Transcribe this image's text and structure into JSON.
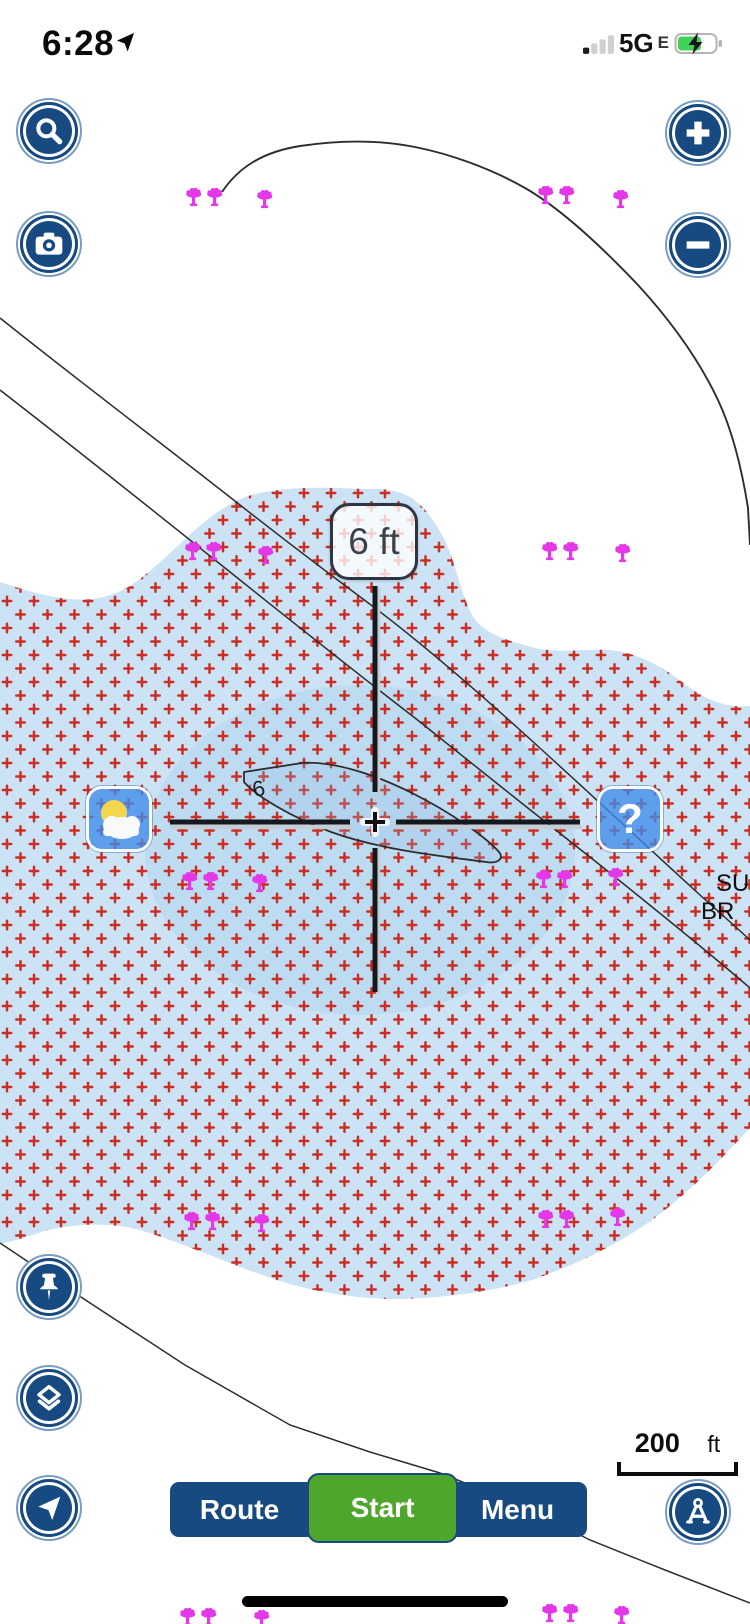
{
  "status_bar": {
    "time": "6:28",
    "network": "5G",
    "network_band": "E"
  },
  "map": {
    "depth_label": "6 ft",
    "contour_depth_label": "6",
    "place_name": {
      "line1": "SU",
      "line2": "BR"
    },
    "scale_bar": {
      "distance": "200",
      "unit": "ft"
    },
    "markers": [
      {
        "kind": "pair",
        "x": 184,
        "y": 186
      },
      {
        "kind": "single",
        "x": 255,
        "y": 188
      },
      {
        "kind": "pair",
        "x": 536,
        "y": 184
      },
      {
        "kind": "single",
        "x": 611,
        "y": 188
      },
      {
        "kind": "pair",
        "x": 183,
        "y": 540
      },
      {
        "kind": "single",
        "x": 256,
        "y": 544
      },
      {
        "kind": "pair",
        "x": 540,
        "y": 540
      },
      {
        "kind": "single",
        "x": 613,
        "y": 542
      },
      {
        "kind": "pair",
        "x": 180,
        "y": 870
      },
      {
        "kind": "single",
        "x": 250,
        "y": 872
      },
      {
        "kind": "pair",
        "x": 534,
        "y": 868
      },
      {
        "kind": "single",
        "x": 606,
        "y": 866
      },
      {
        "kind": "pair",
        "x": 182,
        "y": 1210
      },
      {
        "kind": "single",
        "x": 252,
        "y": 1212
      },
      {
        "kind": "pair",
        "x": 536,
        "y": 1208
      },
      {
        "kind": "single",
        "x": 608,
        "y": 1206
      },
      {
        "kind": "pair",
        "x": 178,
        "y": 1606
      },
      {
        "kind": "single",
        "x": 252,
        "y": 1608
      },
      {
        "kind": "pair",
        "x": 540,
        "y": 1602
      },
      {
        "kind": "single",
        "x": 612,
        "y": 1604
      }
    ],
    "colors": {
      "water": "#cbe3f5",
      "shallow_dot_red": "#cb2f23",
      "fish_attractor_magenta": "#e438e8",
      "contour_line": "#2d2d2d",
      "button_navy": "#174a80",
      "start_green": "#4fa62c"
    }
  },
  "overlay": {
    "help_glyph": "?"
  },
  "bottom_bar": {
    "route": "Route",
    "start": "Start",
    "menu": "Menu"
  }
}
